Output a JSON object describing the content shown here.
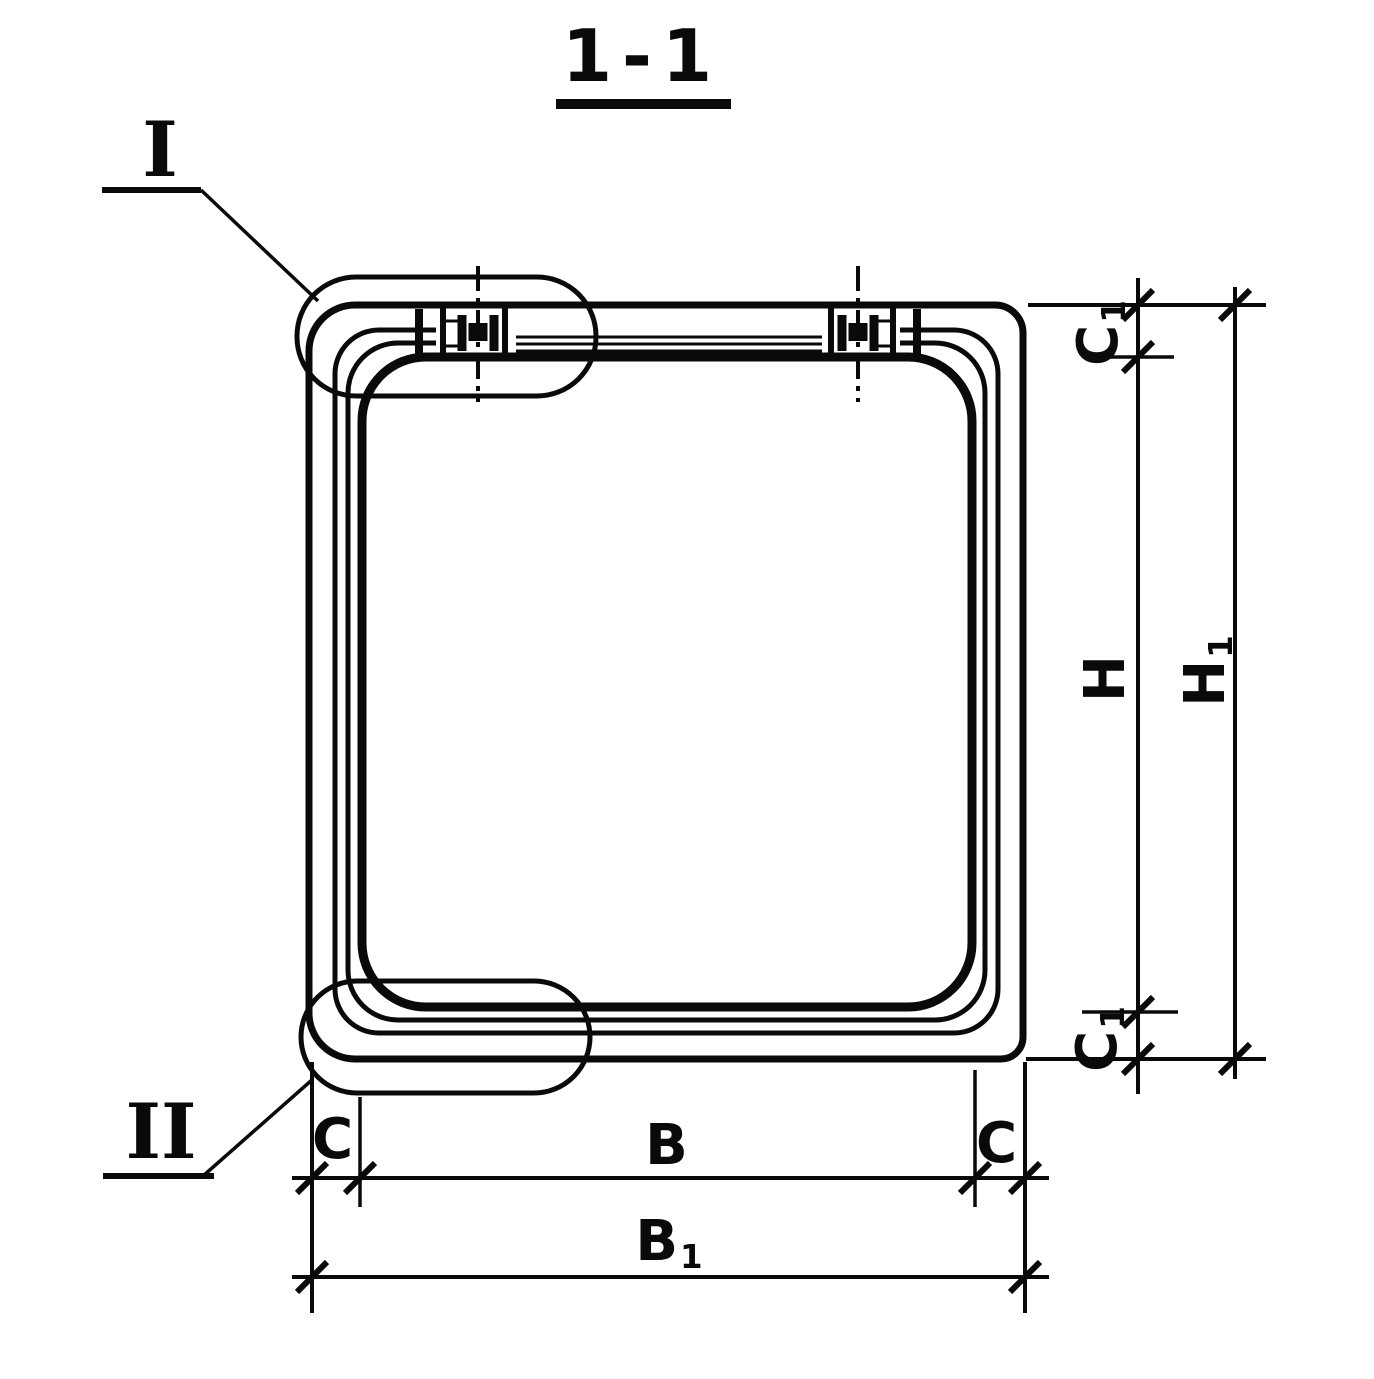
{
  "colors": {
    "ink": "#0a0a0a",
    "paper": "#ffffff"
  },
  "title": {
    "text": "1-1"
  },
  "callouts": {
    "detail_1": {
      "label": "I"
    },
    "detail_2": {
      "label": "II"
    }
  },
  "dimensions": {
    "c1_top": {
      "base": "C",
      "sub": "1"
    },
    "h": {
      "base": "H",
      "sub": ""
    },
    "h1": {
      "base": "H",
      "sub": "1"
    },
    "c1_bottom": {
      "base": "C",
      "sub": "1"
    },
    "c_left": {
      "base": "C",
      "sub": ""
    },
    "b": {
      "base": "B",
      "sub": ""
    },
    "c_right": {
      "base": "C",
      "sub": ""
    },
    "b1": {
      "base": "B",
      "sub": "1"
    }
  }
}
